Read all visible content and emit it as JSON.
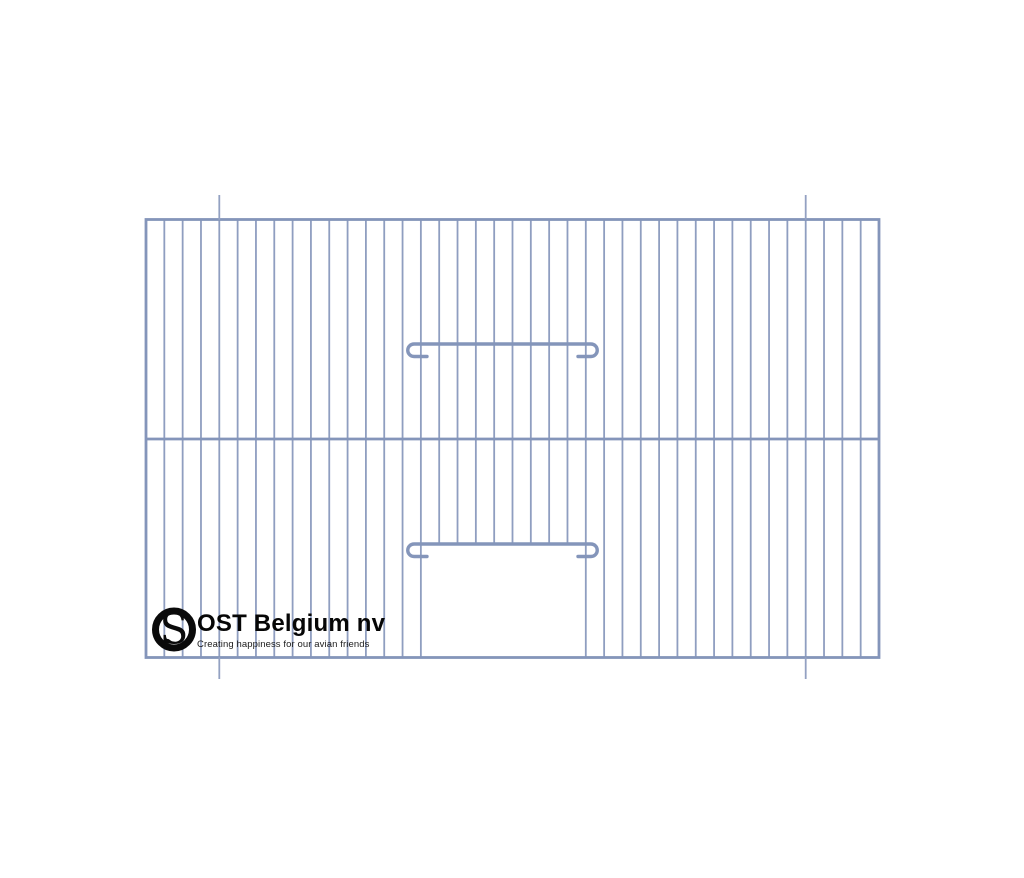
{
  "brand": {
    "name": "OST Belgium nv",
    "tagline": "Creating happiness for our avian friends",
    "mark_letter": "S"
  },
  "drawing": {
    "title": "cage-front-panel-drawing",
    "colors": {
      "wire": "#8f9ec0",
      "frame": "#8495ba",
      "latch": "#8495ba",
      "reference": "#93a1c2",
      "background": "#ffffff",
      "logo_ink": "#0a0a0a"
    },
    "frame": {
      "x": 146,
      "y": 219.5,
      "width": 733,
      "height": 438
    },
    "wire_gaps": 40,
    "mid_rail_offset": 0.5,
    "door": {
      "left_wire_index": 15,
      "right_wire_index": 24,
      "opening_top_y": 544
    },
    "latches": [
      {
        "bar_y": 344,
        "left_x": 414,
        "right_x": 591,
        "hook_radius": 6.25,
        "stub_length": 13
      },
      {
        "bar_y": 544,
        "left_x": 414,
        "right_x": 591,
        "hook_radius": 6.25,
        "stub_length": 13
      }
    ],
    "reference_lines": {
      "wire_indices": [
        4,
        36
      ],
      "top_segment": {
        "y1": 195,
        "y2": 220
      },
      "bottom_segment": {
        "y1": 657,
        "y2": 679
      }
    },
    "stroke_widths": {
      "wire": 1.8,
      "frame": 2.8,
      "mid_rail": 2.8,
      "latch": 3.4,
      "reference": 1.8
    }
  }
}
